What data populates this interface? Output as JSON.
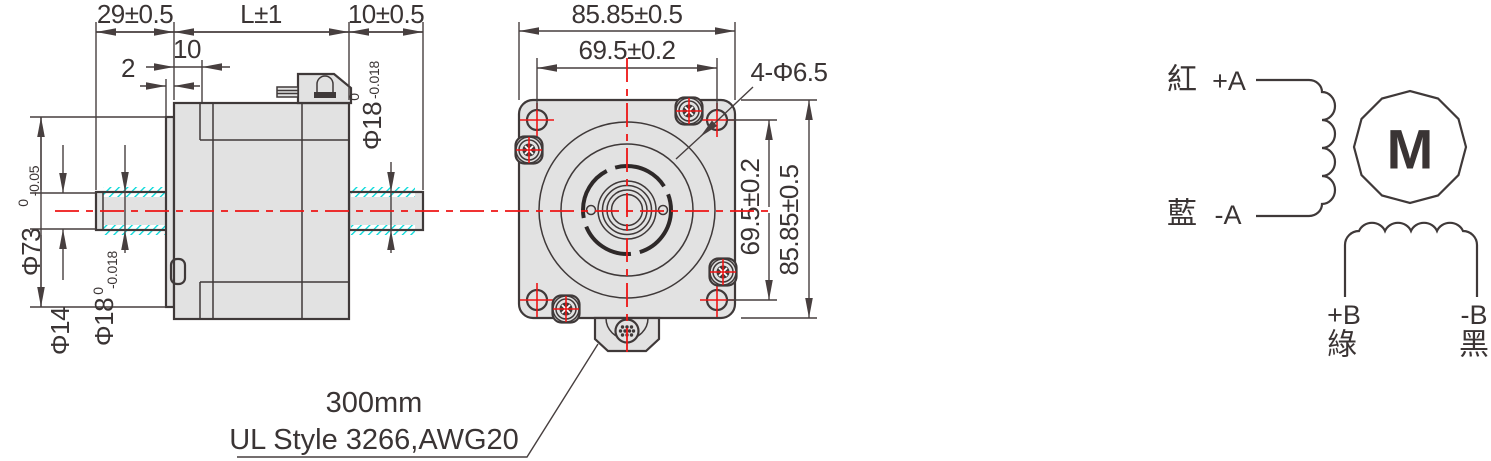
{
  "side_view": {
    "dim_length_front": "29±0.5",
    "dim_length_body": "L±1",
    "dim_length_rear": "10±0.5",
    "dim_pilot_depth": "10",
    "dim_boss_depth": "2",
    "dia_pilot": {
      "label": "Φ73",
      "tol_upper": "0",
      "tol_lower": "-0.05"
    },
    "dia_shaft_front_tip": "Φ14",
    "dia_shaft_front": {
      "label": "Φ18",
      "tol_upper": "0",
      "tol_lower": "-0.018"
    },
    "dia_shaft_rear": {
      "label": "Φ18",
      "tol_upper": "0",
      "tol_lower": "-0.018"
    }
  },
  "front_view": {
    "dim_width": "85.85±0.5",
    "dim_bolt_spacing_h": "69.5±0.2",
    "mount_holes": "4-Φ6.5",
    "dim_bolt_spacing_v": "69.5±0.2",
    "dim_height": "85.85±0.5"
  },
  "lead_wire_note": {
    "line1": "300mm",
    "line2": "UL Style 3266,AWG20"
  },
  "wiring_diagram": {
    "phase_a_plus_color": "紅",
    "phase_a_plus": "+A",
    "phase_a_minus_color": "藍",
    "phase_a_minus": "-A",
    "phase_b_plus": "+B",
    "phase_b_plus_color": "綠",
    "phase_b_minus": "-B",
    "phase_b_minus_color": "黑",
    "motor_symbol": "M"
  },
  "colors": {
    "outline": "#3f3939",
    "dimension": "#473f3f",
    "body_fill": "#e2e2e2",
    "centerline_red": "#ee1515",
    "hatch_cyan": "#00d8d8"
  }
}
